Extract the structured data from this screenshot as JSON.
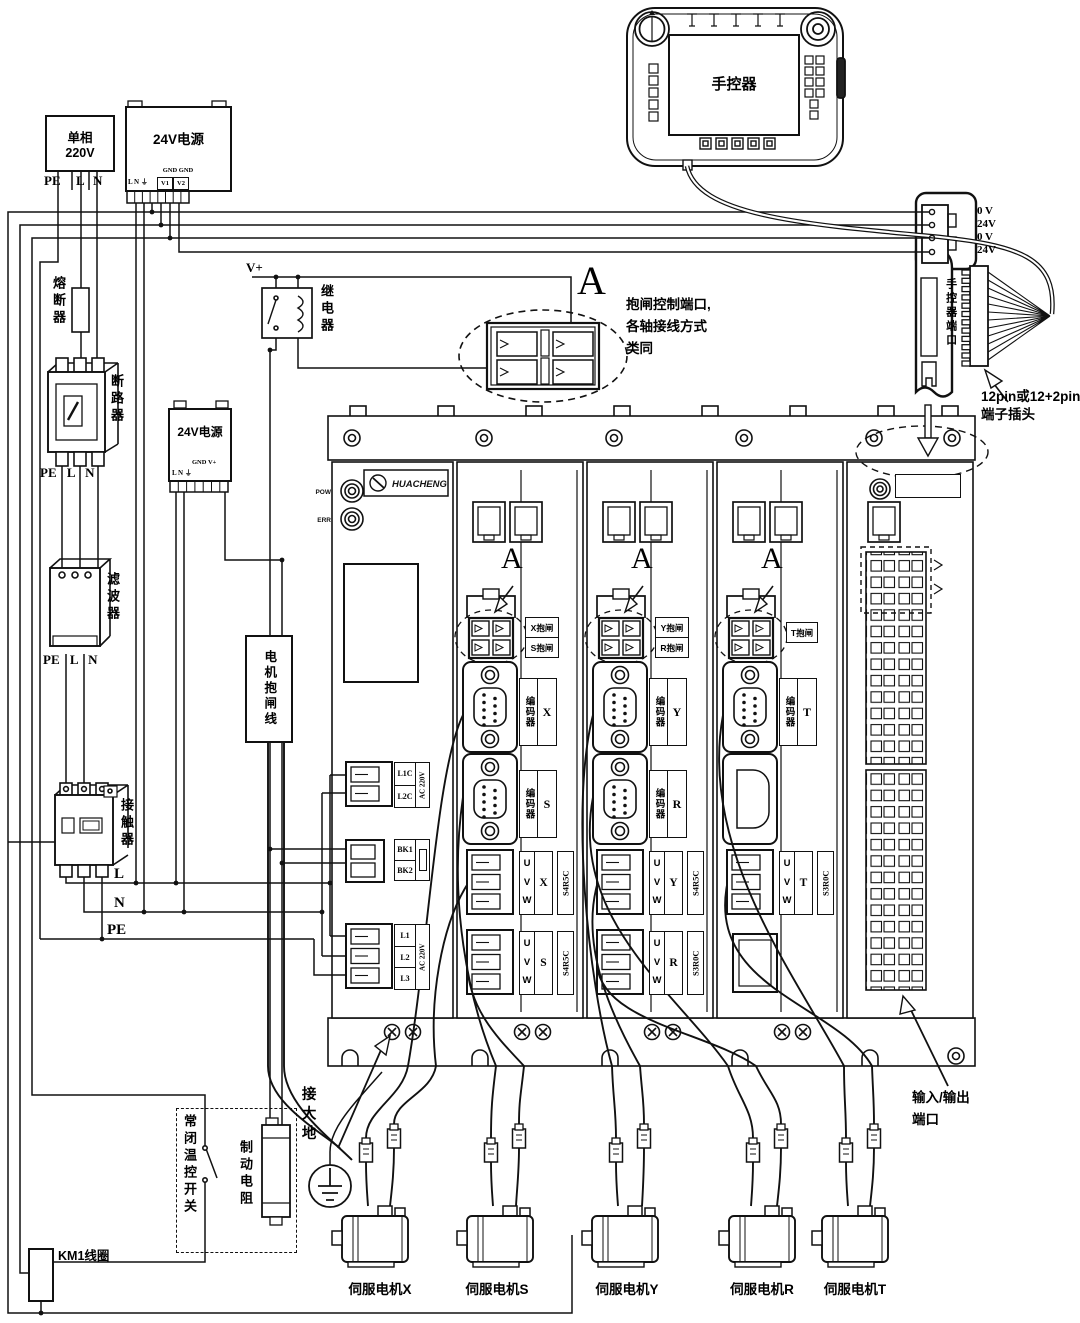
{
  "mains": {
    "line1": "单相",
    "line2": "220V",
    "pe": "PE",
    "l": "L",
    "n": "N"
  },
  "psu1": {
    "title": "24V电源",
    "gnd": "GND GND",
    "lng": "L N ⏚",
    "v1": "V1",
    "v2": "V2"
  },
  "psu2": {
    "title": "24V电源",
    "gnd": "GND V+",
    "lng": "L N ⏚"
  },
  "left": {
    "fuse": "熔断器",
    "breaker": "断路器",
    "filter": "滤波器",
    "contactor": "接触器",
    "peln": "PE L N"
  },
  "relay": {
    "vplus": "V+",
    "name": "继电器"
  },
  "brakeline": "电机抱闸线",
  "bus": {
    "l": "L",
    "n": "N",
    "pe": "PE"
  },
  "pendant": {
    "title": "手控器"
  },
  "port": {
    "p1": "0 V",
    "p2": "24V",
    "p3": "0 V",
    "p4": "24V",
    "label": "手控器端口",
    "note1": "12pin或12+2pin",
    "note2": "端子插头"
  },
  "detail": {
    "a": "A",
    "n1": "抱闸控制端口,",
    "n2": "各轴接线方式",
    "n3": "类同"
  },
  "rack": {
    "pow": "POW",
    "err": "ERR",
    "brand": "HUACHENG",
    "pm": {
      "l1c": "L1C",
      "l2c": "L2C",
      "ac": "AC 220V",
      "bk1": "BK1",
      "bk2": "BK2",
      "l1": "L1",
      "l2": "L2",
      "l3": "L3"
    },
    "d1": {
      "a": "A",
      "b1": "X抱闸",
      "b2": "S抱闸",
      "enc": "编码器",
      "e1": "X",
      "e2": "S",
      "uvw": "U V W",
      "x1": "X",
      "x2": "S",
      "m1": "S4R5C",
      "m2": "S4R5C"
    },
    "d2": {
      "a": "A",
      "b1": "Y抱闸",
      "b2": "R抱闸",
      "enc": "编码器",
      "e1": "Y",
      "e2": "R",
      "uvw": "U V W",
      "x1": "Y",
      "x2": "R",
      "m1": "S4R5C",
      "m2": "S3R0C"
    },
    "d3": {
      "a": "A",
      "b1": "T抱闸",
      "enc": "编码器",
      "e1": "T",
      "uvw": "U V W",
      "x1": "T",
      "m1": "S3R0C"
    },
    "io": {
      "n1": "输入/输出",
      "n2": "端口"
    }
  },
  "bottom": {
    "ground": "接大地",
    "thermal": "常闭温控开关",
    "resistor": "制动电阻",
    "km1": "KM1线圈"
  },
  "motors": {
    "m1": "伺服电机X",
    "m2": "伺服电机S",
    "m3": "伺服电机Y",
    "m4": "伺服电机R",
    "m5": "伺服电机T"
  }
}
